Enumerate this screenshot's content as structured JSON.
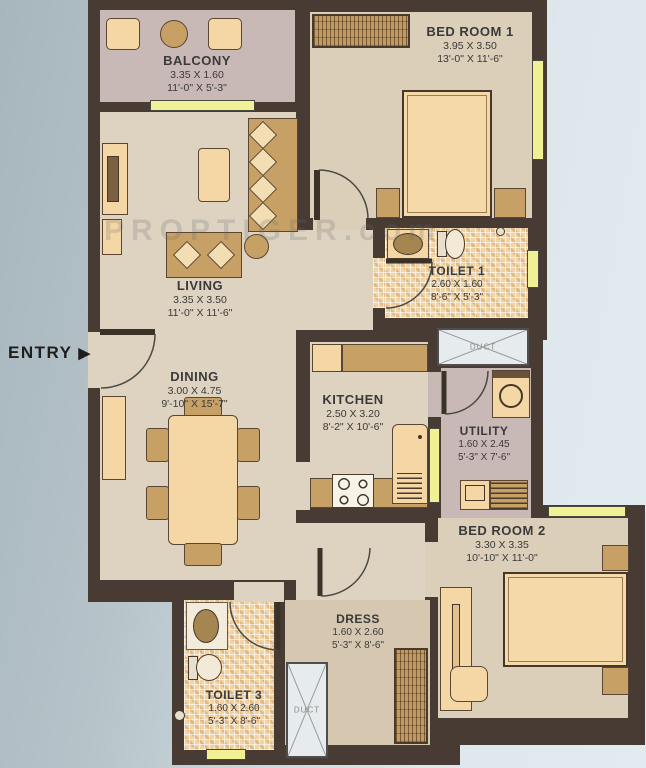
{
  "plan": {
    "entry_label": "ENTRY",
    "entry_arrow": "▶",
    "watermark": "PROPTIGER.com",
    "rooms": [
      {
        "id": "balcony",
        "name": "BALCONY",
        "dim_m": "3.35 X 1.60",
        "dim_ft": "11'-0\" X 5'-3\""
      },
      {
        "id": "bedroom1",
        "name": "BED ROOM 1",
        "dim_m": "3.95 X 3.50",
        "dim_ft": "13'-0\" X 11'-6\""
      },
      {
        "id": "living",
        "name": "LIVING",
        "dim_m": "3.35 X 3.50",
        "dim_ft": "11'-0\" X 11'-6\""
      },
      {
        "id": "toilet1",
        "name": "TOILET 1",
        "dim_m": "2.60 X 1.60",
        "dim_ft": "8'-6\" X 5'-3\""
      },
      {
        "id": "dining",
        "name": "DINING",
        "dim_m": "3.00 X 4.75",
        "dim_ft": "9'-10\" X 15'-7\""
      },
      {
        "id": "kitchen",
        "name": "KITCHEN",
        "dim_m": "2.50 X 3.20",
        "dim_ft": "8'-2\" X 10'-6\""
      },
      {
        "id": "utility",
        "name": "UTILITY",
        "dim_m": "1.60 X 2.45",
        "dim_ft": "5'-3\" X 7'-6\""
      },
      {
        "id": "bedroom2",
        "name": "BED ROOM 2",
        "dim_m": "3.30 X 3.35",
        "dim_ft": "10'-10\" X 11'-0\""
      },
      {
        "id": "dress",
        "name": "DRESS",
        "dim_m": "1.60 X 2.60",
        "dim_ft": "5'-3\" X 8'-6\""
      },
      {
        "id": "toilet3",
        "name": "TOILET 3",
        "dim_m": "1.60 X 2.60",
        "dim_ft": "5'-3\" X 8'-6\""
      }
    ],
    "ducts": [
      {
        "label": "DUCT"
      },
      {
        "label": "DUCT"
      }
    ],
    "colors": {
      "wall": "#483b34",
      "floor": "#ddd3c0",
      "balcony_utility_floor": "#c9b9b6",
      "toilet_tile": "#eed5a8",
      "window": "#f0f195",
      "furniture": "#f4d7a5",
      "background_left": "#a7b6bd",
      "background_right": "#e2ebf0"
    }
  }
}
